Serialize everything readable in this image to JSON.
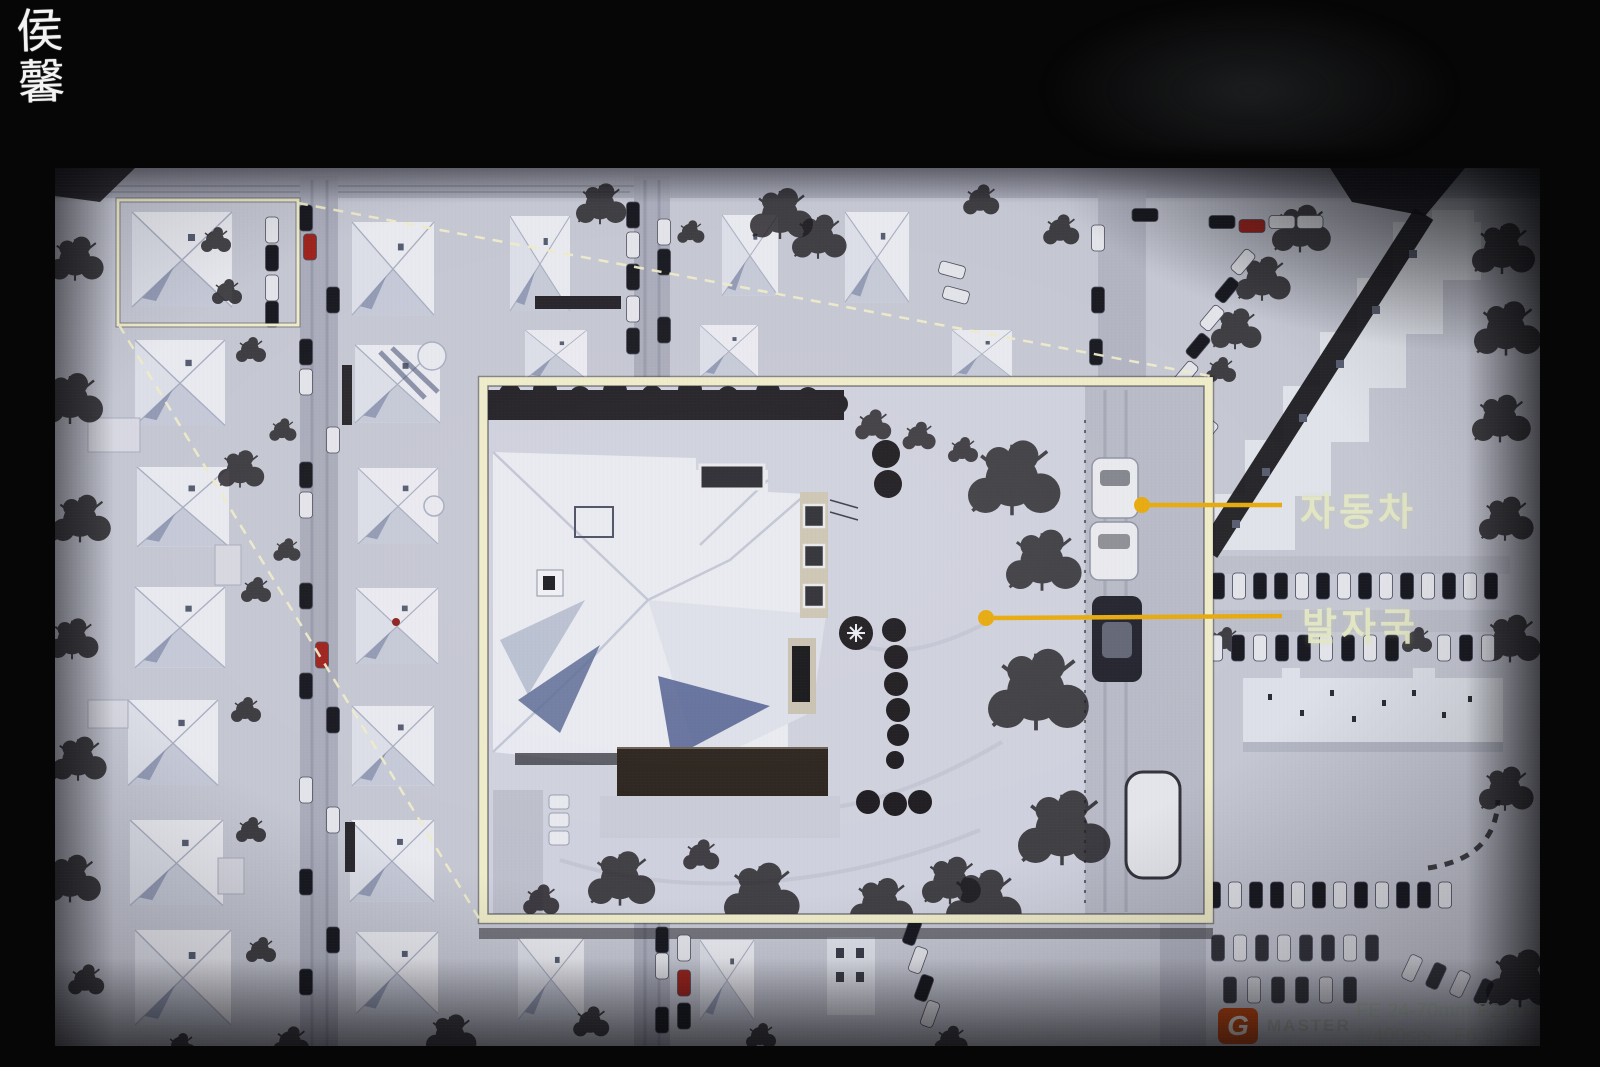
{
  "artist_watermark": {
    "text": "侯馨",
    "color": "#f3f3f3"
  },
  "callouts": {
    "accent_color": "#e7aa0e",
    "frame_color": "#efecca",
    "label_color": "#e4e8c4",
    "labels": {
      "car": "자동차",
      "footprints": "발자국"
    }
  },
  "camera_watermark": {
    "logo_letter": "G",
    "logo_color": "#cf4a0e",
    "brand": "MASTER",
    "lens_line_prefix": "FE 24-70mm F2.8 GM on ",
    "lens_line_alpha": "α",
    "lens_line_camera": "7RII",
    "settings_line": "1/400sec., F6.3, ISO 400"
  }
}
